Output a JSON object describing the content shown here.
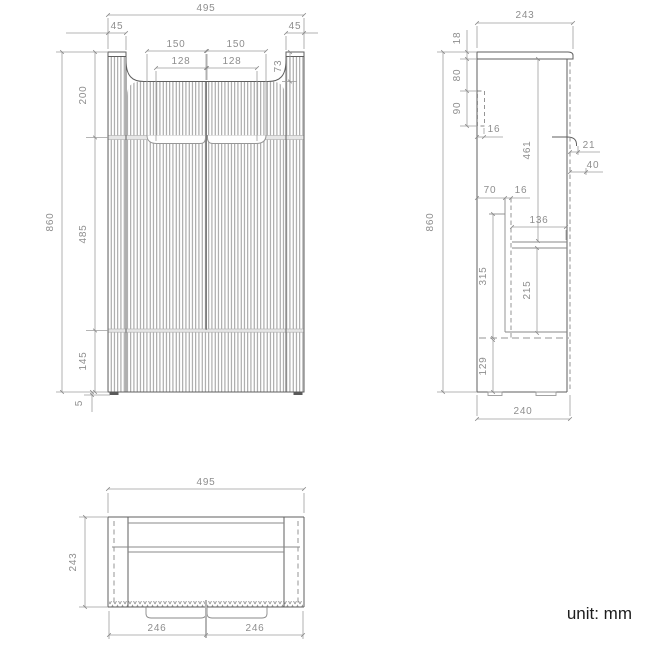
{
  "unit_note": "unit: mm",
  "colors": {
    "outline": "#5f5f5f",
    "inner_line": "#8a8a8a",
    "dim_line": "#9d9d9d",
    "dim_text": "#8e8e8e",
    "note_text": "#1d1d1d"
  },
  "views": {
    "front": {
      "total_width": "495",
      "left_post_width": "45",
      "right_post_width": "45",
      "left_handle_outer": "150",
      "right_handle_outer": "150",
      "left_handle_inner": "128",
      "right_handle_inner": "128",
      "post_above_top": "73",
      "top_section_height": "200",
      "total_height": "860",
      "middle_section_height": "485",
      "bottom_section_height": "145",
      "foot_height": "5"
    },
    "side": {
      "top_depth": "243",
      "top_thickness": "18",
      "gap_below_top": "80",
      "rail_height": "90",
      "wall_rail_thickness": "16",
      "interior_height": "461",
      "handle_recess_depth": "21",
      "handle_recess_height": "40",
      "back_offset": "70",
      "panel_thickness": "16",
      "drawer_depth": "136",
      "total_height": "860",
      "drawer_box_height": "315",
      "inner_drawer_height": "215",
      "bottom_clearance": "129",
      "bottom_depth": "240"
    },
    "top": {
      "total_width": "495",
      "total_depth": "243",
      "left_door_width": "246",
      "right_door_width": "246"
    }
  }
}
